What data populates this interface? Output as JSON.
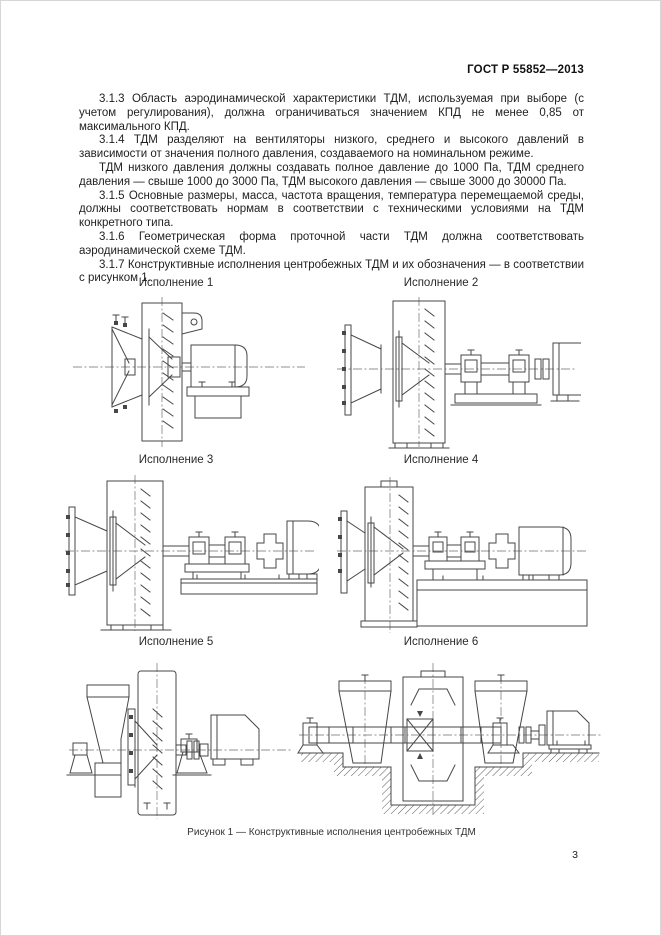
{
  "page": {
    "header": "ГОСТ Р 55852—2013",
    "page_number": "3"
  },
  "body": {
    "paragraphs": [
      "3.1.3  Область аэродинамической характеристики ТДМ, используемая при выборе (с учетом регулирования), должна ограничиваться значением КПД не менее 0,85 от максимального КПД.",
      "3.1.4  ТДМ разделяют на вентиляторы низкого, среднего и высокого давлений в зависимости от значения полного давления, создаваемого на номинальном режиме.",
      "ТДМ низкого давления должны создавать полное давление до 1000 Па, ТДМ среднего давления — свыше 1000 до 3000 Па, ТДМ высокого давления — свыше 3000 до 30000 Па.",
      "3.1.5  Основные размеры, масса, частота вращения, температура перемещаемой среды, должны соответствовать нормам в соответствии с техническими условиями на ТДМ конкретного типа.",
      "3.1.6  Геометрическая форма проточной части ТДМ должна соответствовать аэродинамической схеме ТДМ.",
      "3.1.7  Конструктивные исполнения центробежных ТДМ и их обозначения — в соответствии с рисунком 1."
    ]
  },
  "figure": {
    "caption": "Рисунок 1 — Конструктивные исполнения центробежных ТДМ",
    "executions": [
      {
        "label": "Исполнение 1"
      },
      {
        "label": "Исполнение 2"
      },
      {
        "label": "Исполнение 3"
      },
      {
        "label": "Исполнение 4"
      },
      {
        "label": "Исполнение 5"
      },
      {
        "label": "Исполнение 6"
      }
    ]
  }
}
